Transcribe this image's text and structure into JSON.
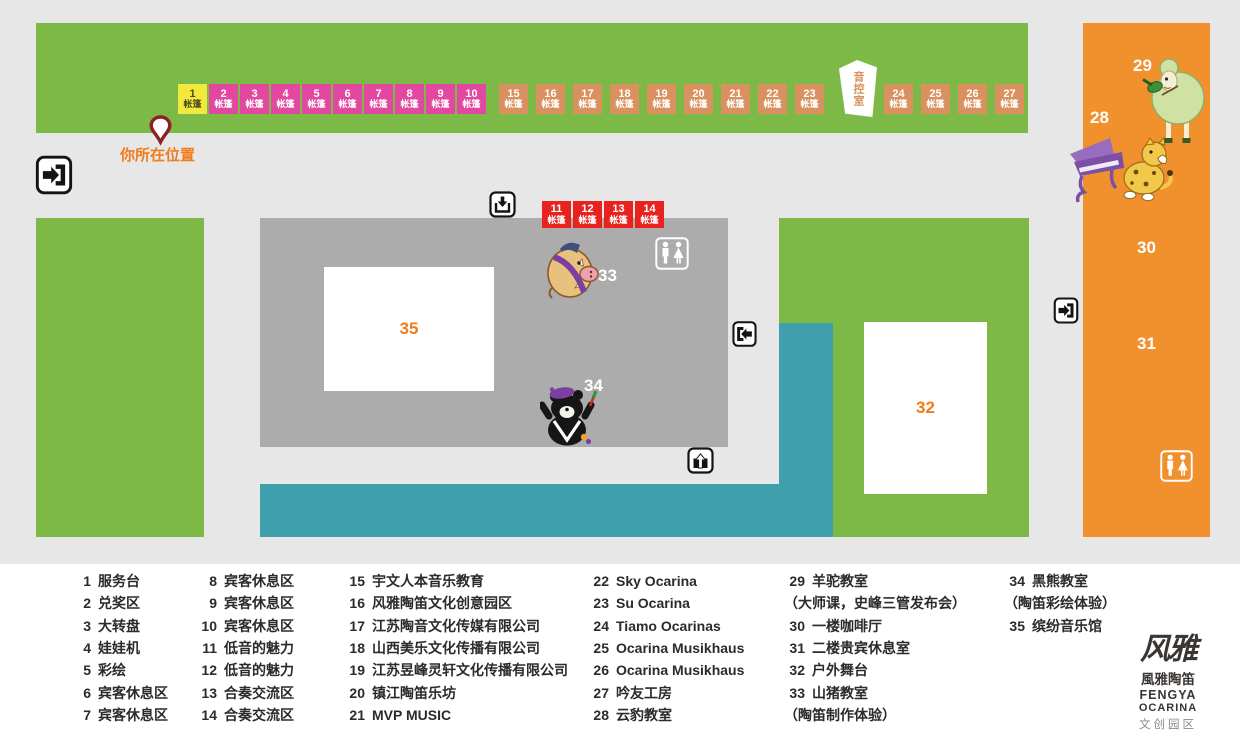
{
  "colors": {
    "lawn_green": "#7db947",
    "building_gray": "#acacac",
    "walkway_teal": "#3f9fab",
    "hall_orange": "#f1912e",
    "tent_yellow": "#f3e93c",
    "tent_magenta": "#e2489f",
    "tent_salmon": "#d9925f",
    "tent_red": "#e8231f",
    "accent_orange": "#f07c1a",
    "background": "#e7e7e8"
  },
  "icons": {
    "entrance_left": "door-enter-icon",
    "entrance_right": "door-enter-icon",
    "door_exit_left": "door-exit-left-icon",
    "gate_in": "arrow-into-tray-icon",
    "gate_out": "arrow-out-of-tray-icon",
    "restroom": "restroom-icon",
    "location_pin": "location-pin-icon"
  },
  "map": {
    "your_location": "你所在位置",
    "sound_room": "音控室",
    "tents": {
      "suffix": "帐篷",
      "top_left": [
        {
          "n": "1",
          "c": "y"
        },
        {
          "n": "2",
          "c": "m"
        },
        {
          "n": "3",
          "c": "m"
        },
        {
          "n": "4",
          "c": "m"
        },
        {
          "n": "5",
          "c": "m"
        },
        {
          "n": "6",
          "c": "m"
        },
        {
          "n": "7",
          "c": "m"
        },
        {
          "n": "8",
          "c": "m"
        },
        {
          "n": "9",
          "c": "m"
        },
        {
          "n": "10",
          "c": "m"
        }
      ],
      "top_mid": [
        {
          "n": "15",
          "c": "s"
        },
        {
          "n": "16",
          "c": "s"
        },
        {
          "n": "17",
          "c": "s"
        },
        {
          "n": "18",
          "c": "s"
        },
        {
          "n": "19",
          "c": "s"
        },
        {
          "n": "20",
          "c": "s"
        },
        {
          "n": "21",
          "c": "s"
        },
        {
          "n": "22",
          "c": "s"
        },
        {
          "n": "23",
          "c": "s"
        }
      ],
      "top_right": [
        {
          "n": "24",
          "c": "s"
        },
        {
          "n": "25",
          "c": "s"
        },
        {
          "n": "26",
          "c": "s"
        },
        {
          "n": "27",
          "c": "s"
        }
      ],
      "building": [
        {
          "n": "11",
          "c": "r"
        },
        {
          "n": "12",
          "c": "r"
        },
        {
          "n": "13",
          "c": "r"
        },
        {
          "n": "14",
          "c": "r"
        }
      ]
    },
    "areas": {
      "a28": "28",
      "a29": "29",
      "a30": "30",
      "a31": "31",
      "a32": "32",
      "a33": "33",
      "a34": "34",
      "a35": "35"
    }
  },
  "legend": {
    "columns": [
      [
        {
          "n": "1",
          "t": "服务台"
        },
        {
          "n": "2",
          "t": "兑奖区"
        },
        {
          "n": "3",
          "t": "大转盘"
        },
        {
          "n": "4",
          "t": "娃娃机"
        },
        {
          "n": "5",
          "t": "彩绘"
        },
        {
          "n": "6",
          "t": "宾客休息区"
        },
        {
          "n": "7",
          "t": "宾客休息区"
        }
      ],
      [
        {
          "n": "8",
          "t": "宾客休息区"
        },
        {
          "n": "9",
          "t": "宾客休息区"
        },
        {
          "n": "10",
          "t": "宾客休息区"
        },
        {
          "n": "11",
          "t": "低音的魅力"
        },
        {
          "n": "12",
          "t": "低音的魅力"
        },
        {
          "n": "13",
          "t": "合奏交流区"
        },
        {
          "n": "14",
          "t": "合奏交流区"
        }
      ],
      [
        {
          "n": "15",
          "t": "宇文人本音乐教育"
        },
        {
          "n": "16",
          "t": "风雅陶笛文化创意园区"
        },
        {
          "n": "17",
          "t": "江苏陶音文化传媒有限公司"
        },
        {
          "n": "18",
          "t": "山西美乐文化传播有限公司"
        },
        {
          "n": "19",
          "t": "江苏昱峰灵轩文化传播有限公司"
        },
        {
          "n": "20",
          "t": "镇江陶笛乐坊"
        },
        {
          "n": "21",
          "t": "MVP MUSIC"
        }
      ],
      [
        {
          "n": "22",
          "t": "Sky Ocarina"
        },
        {
          "n": "23",
          "t": "Su Ocarina"
        },
        {
          "n": "24",
          "t": "Tiamo Ocarinas"
        },
        {
          "n": "25",
          "t": "Ocarina Musikhaus"
        },
        {
          "n": "26",
          "t": "Ocarina Musikhaus"
        },
        {
          "n": "27",
          "t": "吟友工房"
        },
        {
          "n": "28",
          "t": "云豹教室"
        }
      ],
      [
        {
          "n": "29",
          "t": "羊驼教室"
        },
        {
          "n": "",
          "t": "（大师课，史峰三管发布会）"
        },
        {
          "n": "30",
          "t": "一楼咖啡厅"
        },
        {
          "n": "31",
          "t": "二楼贵宾休息室"
        },
        {
          "n": "32",
          "t": "户外舞台"
        },
        {
          "n": "33",
          "t": "山猪教室"
        },
        {
          "n": "",
          "t": "（陶笛制作体验）"
        }
      ],
      [
        {
          "n": "34",
          "t": "黑熊教室"
        },
        {
          "n": "",
          "t": "（陶笛彩绘体验）"
        },
        {
          "n": "35",
          "t": "缤纷音乐馆"
        }
      ]
    ]
  },
  "logo": {
    "mark": "风雅",
    "name_cn": "風雅陶笛",
    "name_en_1": "FENGYA",
    "name_en_2": "OCARINA",
    "subtitle": "文创园区"
  }
}
